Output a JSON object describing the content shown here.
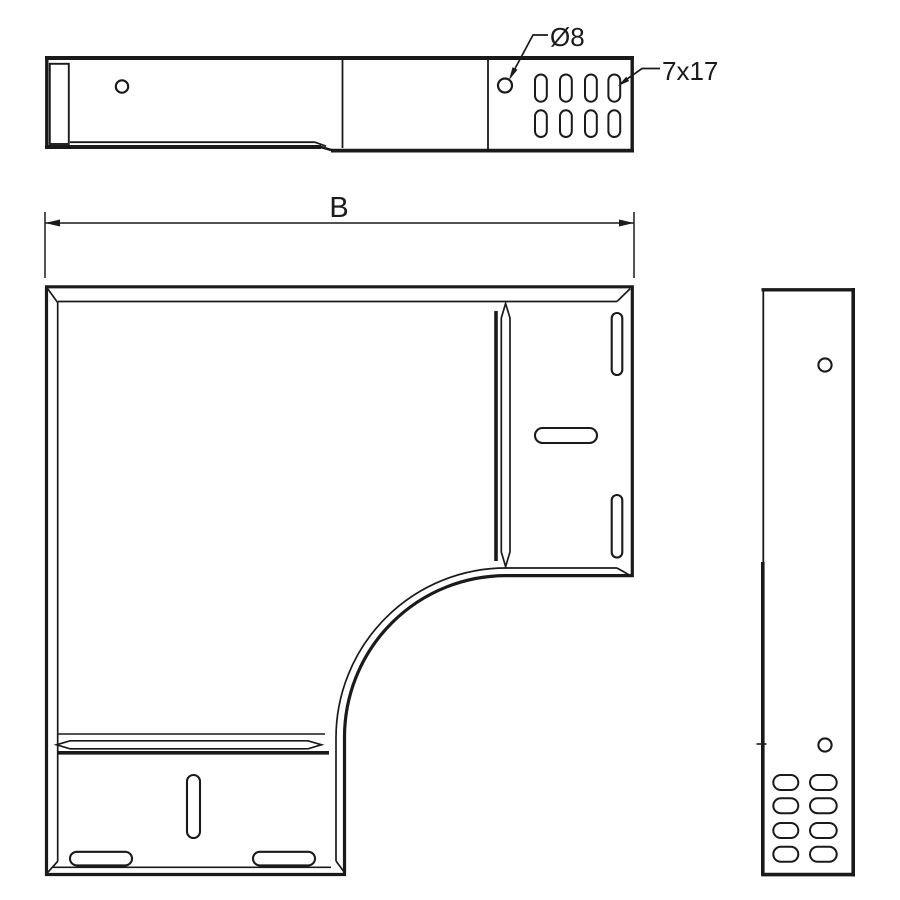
{
  "page": {
    "background": "#ffffff",
    "line_color": "#1a1a1a"
  },
  "drawing": {
    "top_view": {
      "annotations": {
        "hole_diameter": "Ø8",
        "slot_size": "7x17"
      }
    },
    "plan_view": {
      "dimension_width": "B"
    }
  }
}
